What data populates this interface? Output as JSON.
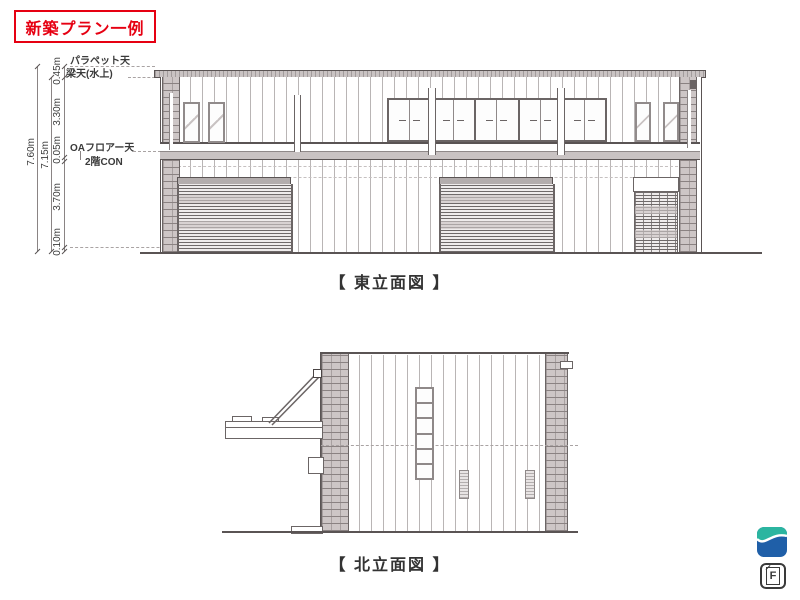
{
  "plan_badge": {
    "label": "新築プラン一例"
  },
  "east_elevation": {
    "caption": "【 東立面図 】",
    "dimensions": {
      "total_height": "7.60m",
      "upper_height": "7.15m",
      "parapet": "0.45m",
      "second_floor": "3.30m",
      "oa_floor": "0.05m",
      "first_floor": "3.70m",
      "base": "0.10m"
    },
    "level_labels": {
      "parapet_top": "パラペット天",
      "beam_top": "梁天(水上)",
      "oa_floor_top": "OAフロアー天",
      "second_floor_con": "2階CON"
    }
  },
  "north_elevation": {
    "caption": "【 北立面図 】"
  },
  "branding": {
    "f_icon_label": "F"
  },
  "colors": {
    "accent_red": "#e60012",
    "logo_teal": "#2bb5a0",
    "logo_blue": "#1f5fa8",
    "drawing_line": "#5a5454",
    "hatch_fill": "#cdc6c6"
  }
}
